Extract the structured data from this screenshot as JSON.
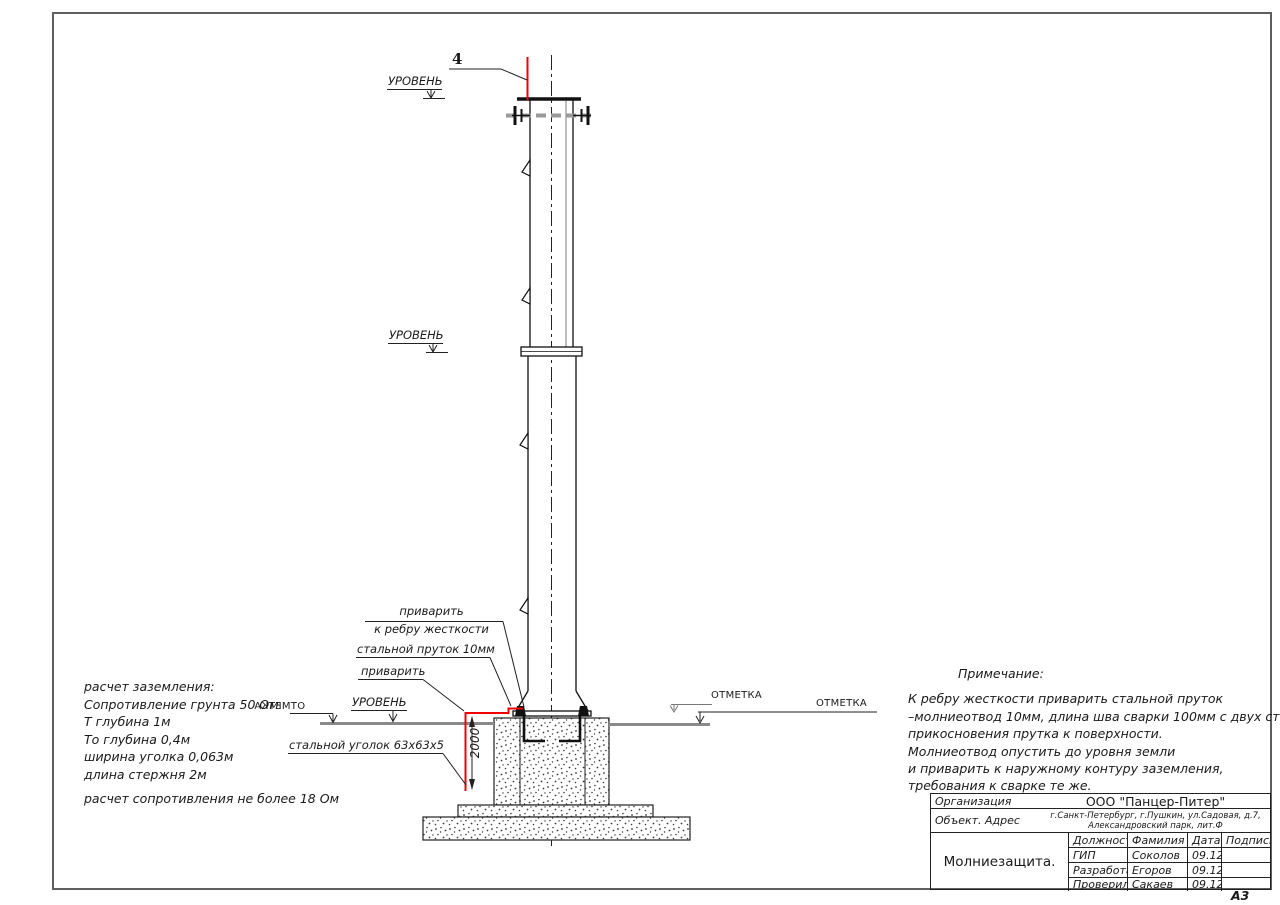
{
  "labels": {
    "detail": "4",
    "level": "УРОВЕНЬ",
    "otmetka": "ОТМЕТКА",
    "weld_rib_line1": "приварить",
    "weld_rib_line2": "к ребру жесткости",
    "steel_rod": "стальной пруток 10мм",
    "weld": "приварить",
    "steel_angle": "стальной уголок 63х63х5",
    "dim_2000": "2000"
  },
  "calc": {
    "lines": [
      "расчет заземления:",
      "Сопротивление грунта 50 Ом",
      "Т глубина 1м",
      "То глубина 0,4м",
      "ширина уголка 0,063м",
      "длина стержня 2м",
      "расчет сопротивления не более 18 Ом"
    ]
  },
  "notes": {
    "title": "Примечание:",
    "lines": [
      "К ребру жесткости приварить стальной пруток",
      "–молниеотвод 10мм, длина шва сварки 100мм с двух сторон",
      "прикосновения прутка к поверхности.",
      "Молниеотвод опустить до уровня земли",
      "и приварить к наружному контуру заземления,",
      "требования к сварке те же."
    ]
  },
  "title_block": {
    "org_label": "Организация",
    "org_value": "ООО \"Панцер-Питер\"",
    "object_label": "Объект. Адрес",
    "address_line1": "г.Санкт-Петербург, г.Пушкин, ул.Садовая, д.7,",
    "address_line2": "Александровский парк, лит.Ф",
    "doc_title": "Молниезащита.",
    "columns": [
      "Должность",
      "Фамилия",
      "Дата",
      "Подпись"
    ],
    "rows": [
      {
        "role": "ГИП",
        "name": "Соколов",
        "date": "09.12",
        "sign": ""
      },
      {
        "role": "Разработал",
        "name": "Егоров",
        "date": "09.12",
        "sign": ""
      },
      {
        "role": "Проверил",
        "name": "Сакаев",
        "date": "09.12",
        "sign": ""
      }
    ],
    "format": "А3"
  },
  "colors": {
    "accent_red": "#f20000",
    "line": "#1a1a1a",
    "level_gray": "#8a8a8a"
  }
}
